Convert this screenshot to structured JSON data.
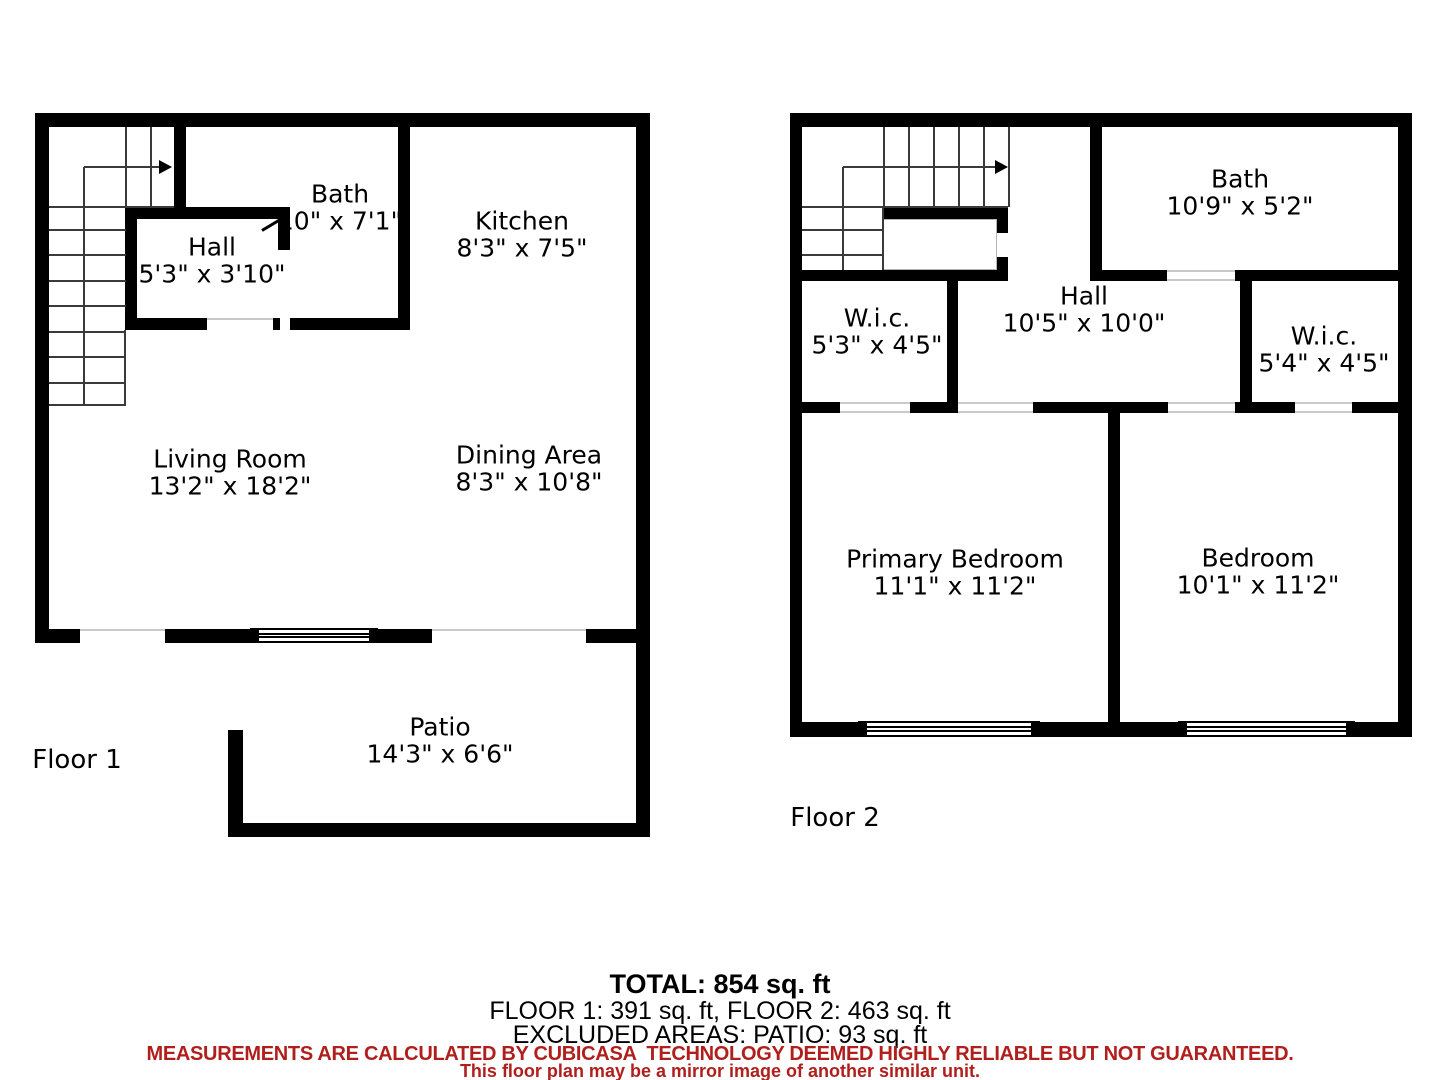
{
  "floor1": {
    "label": "Floor 1",
    "rooms": {
      "hall": {
        "name": "Hall",
        "dims": "5'3\" x 3'10\""
      },
      "bath": {
        "name": "Bath",
        "dims": "10\" x 7'1\""
      },
      "kitchen": {
        "name": "Kitchen",
        "dims": "8'3\" x 7'5\""
      },
      "living": {
        "name": "Living Room",
        "dims": "13'2\" x 18'2\""
      },
      "dining": {
        "name": "Dining Area",
        "dims": "8'3\" x 10'8\""
      },
      "patio": {
        "name": "Patio",
        "dims": "14'3\" x 6'6\""
      }
    }
  },
  "floor2": {
    "label": "Floor 2",
    "rooms": {
      "bath": {
        "name": "Bath",
        "dims": "10'9\" x 5'2\""
      },
      "hall": {
        "name": "Hall",
        "dims": "10'5\" x 10'0\""
      },
      "wic_left": {
        "name": "W.i.c.",
        "dims": "5'3\" x 4'5\""
      },
      "wic_right": {
        "name": "W.i.c.",
        "dims": "5'4\" x 4'5\""
      },
      "primary": {
        "name": "Primary Bedroom",
        "dims": "11'1\" x 11'2\""
      },
      "bedroom": {
        "name": "Bedroom",
        "dims": "10'1\" x 11'2\""
      }
    }
  },
  "summary": {
    "total": "TOTAL: 854 sq. ft",
    "floors": "FLOOR 1: 391 sq. ft, FLOOR 2: 463 sq. ft",
    "excluded": "EXCLUDED AREAS: PATIO: 93 sq. ft"
  },
  "disclaimer": {
    "line1": "MEASUREMENTS ARE CALCULATED BY CUBICASA  TECHNOLOGY DEEMED HIGHLY RELIABLE BUT NOT GUARANTEED.",
    "line2": "This floor plan may be a mirror image of another similar unit.",
    "color": "#b01f1c"
  },
  "colors": {
    "wall": "#000000",
    "tread": "#3a3a3a",
    "opening_sill": "#c9c9c9"
  }
}
